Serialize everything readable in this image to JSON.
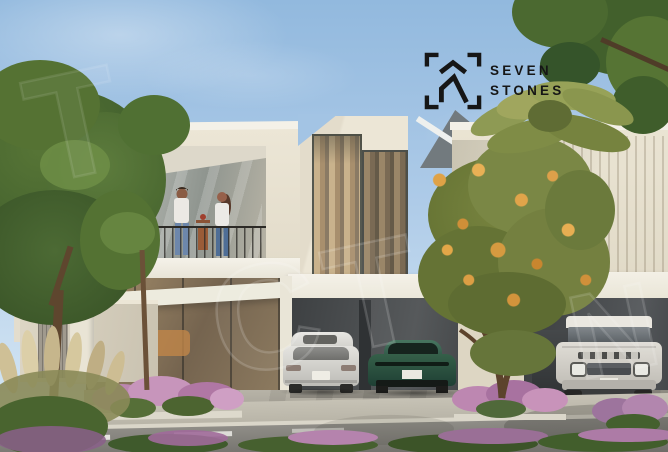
{
  "scene": {
    "description": "Sunny architectural rendering of modern cream two-storey townhouses: a couple stands on a balcony, dark recessed carports hold a white sedan and a green sports car, a white SUV parks at right, with green trees, an orange-flowering tree, palm fronds, tan ornamental grasses and pink shrubs along a road with a dashed lane line",
    "sky_color": "#9abde0",
    "building_color": "#e9e3d2",
    "carport_color": "#46494b",
    "road_color": "#82807b",
    "flower_color": "#bb85ae"
  },
  "logo": {
    "line1": "SEVEN",
    "line2": "STONES",
    "color": "#161616",
    "icon": "chevron-house-in-corner-brackets"
  },
  "watermark": {
    "letters_sky": "T",
    "letters_center": "CT",
    "letters_right": "N"
  },
  "objects": {
    "people": [
      "man on balcony",
      "woman on balcony"
    ],
    "cars": [
      "white sedan (rear)",
      "green sports car (rear)",
      "dark vehicle (partial)",
      "white SUV (front)"
    ]
  }
}
